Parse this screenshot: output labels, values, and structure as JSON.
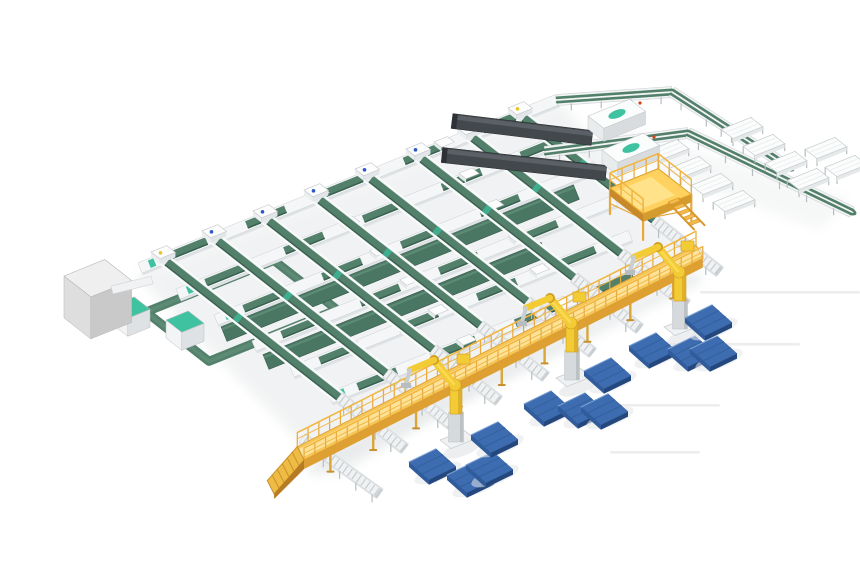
{
  "meta": {
    "title": "Isometric 3D rendering of an automated parcel sorting and palletizing facility",
    "canvas": {
      "w": 860,
      "h": 580
    },
    "background": "#ffffff"
  },
  "colors": {
    "belt": "#53806b",
    "belt_dark": "#39604f",
    "belt_wide": "#4a7763",
    "teal": "#3fc2a0",
    "rail_white": "#f4f6f7",
    "rail_edge": "#c9ced2",
    "roller": "#c3cacd",
    "leg": "#b7bdc0",
    "deck_yellow": "#f6c556",
    "deck_floor": "#fce399",
    "yellow_mid": "#e8a83c",
    "yellow_dark": "#c8892a",
    "platform_top": "#ffd15e",
    "robot_yellow": "#f2cb35",
    "robot_dark": "#cf9d22",
    "robot_light": "#ffe063",
    "pallet_top": "#3e6cb0",
    "pallet_left": "#315c9c",
    "pallet_front": "#24487e",
    "pallet_line": "#32619f",
    "loader_body": "#43484c",
    "loader_top": "#5a6065",
    "loader_tip": "#2e3236",
    "box_top": "#efefef",
    "box_front": "#dedede",
    "box_side": "#c9c9c9",
    "shadow": "#e7e9ea",
    "streak": "#ededed",
    "dot_blue": "#2b59c4",
    "dot_yellow": "#e8c52b",
    "dot_red": "#d84315"
  },
  "scene": {
    "lattice": {
      "lanes": [
        {
          "x": 140,
          "y": 268,
          "len": 450
        },
        {
          "x": 178,
          "y": 294,
          "len": 430
        },
        {
          "x": 216,
          "y": 320,
          "len": 410
        },
        {
          "x": 254,
          "y": 346,
          "len": 390
        },
        {
          "x": 292,
          "y": 372,
          "len": 365
        },
        {
          "x": 330,
          "y": 398,
          "len": 340
        }
      ],
      "wide_belts": [
        {
          "x": 224,
          "y": 334,
          "len": 380
        },
        {
          "x": 266,
          "y": 362,
          "len": 300
        }
      ],
      "belts": [
        {
          "s": [
            163,
            259
          ],
          "t": [
            405,
            449
          ],
          "dot": "#e8c52b"
        },
        {
          "s": [
            214,
            238
          ],
          "t": [
            452,
            425
          ],
          "dot": "#2b59c4"
        },
        {
          "s": [
            265,
            218
          ],
          "t": [
            499,
            401
          ],
          "dot": "#2b59c4"
        },
        {
          "s": [
            316,
            197
          ],
          "t": [
            546,
            377
          ],
          "dot": "#2b59c4"
        },
        {
          "s": [
            367,
            176
          ],
          "t": [
            593,
            353
          ],
          "dot": "#2b59c4"
        },
        {
          "s": [
            418,
            156
          ],
          "t": [
            640,
            329
          ],
          "dot": "#2b59c4"
        },
        {
          "s": [
            469,
            135
          ],
          "t": [
            687,
            305
          ],
          "dot": "#2b59c4"
        },
        {
          "s": [
            520,
            115
          ],
          "t": [
            720,
            272
          ],
          "dot": "#e8c52b"
        }
      ],
      "extra_spurs": [
        {
          "s": [
            302,
            438
          ],
          "t": [
            380,
            494
          ]
        }
      ],
      "spur_len": 84
    },
    "walkway": {
      "p1": [
        300,
        452
      ],
      "p2": [
        688,
        256
      ],
      "ramp_vec": [
        -30,
        34
      ]
    },
    "robots": [
      {
        "x": 456,
        "y": 442
      },
      {
        "x": 572,
        "y": 380
      },
      {
        "x": 680,
        "y": 329
      }
    ],
    "pallets": [
      {
        "x": 432,
        "y": 464
      },
      {
        "x": 470,
        "y": 477
      },
      {
        "x": 489,
        "y": 467
      },
      {
        "x": 494,
        "y": 437
      },
      {
        "x": 547,
        "y": 406
      },
      {
        "x": 581,
        "y": 408
      },
      {
        "x": 604,
        "y": 409
      },
      {
        "x": 607,
        "y": 373
      },
      {
        "x": 652,
        "y": 348
      },
      {
        "x": 691,
        "y": 351
      },
      {
        "x": 713,
        "y": 351
      },
      {
        "x": 708,
        "y": 320
      }
    ],
    "platform": {
      "o": [
        610,
        188
      ],
      "a": 52,
      "b": 42,
      "h": 26
    },
    "loaders": [
      {
        "boom": [
          [
            452,
            121
          ],
          [
            592,
            138
          ]
        ],
        "base": [
          588,
          116
        ],
        "teal": [
          617,
          114
        ],
        "red": [
          640,
          103
        ]
      },
      {
        "boom": [
          [
            442,
            155
          ],
          [
            606,
            173
          ]
        ],
        "base": [
          602,
          150
        ],
        "teal": [
          631,
          148
        ],
        "red": [
          654,
          137
        ]
      }
    ],
    "lines": {
      "top": [
        [
          557,
          100
        ],
        [
          672,
          92
        ]
      ],
      "spineA": [
        [
          672,
          92
        ],
        [
          790,
          168
        ]
      ],
      "spineM": [
        [
          545,
          152
        ],
        [
          688,
          133
        ],
        [
          852,
          212
        ]
      ]
    },
    "chutes": [
      {
        "x": 668,
        "y": 150
      },
      {
        "x": 690,
        "y": 167
      },
      {
        "x": 712,
        "y": 184
      },
      {
        "x": 734,
        "y": 201
      },
      {
        "x": 742,
        "y": 128
      },
      {
        "x": 764,
        "y": 145
      },
      {
        "x": 786,
        "y": 162
      },
      {
        "x": 808,
        "y": 179
      },
      {
        "x": 826,
        "y": 148
      },
      {
        "x": 846,
        "y": 166
      }
    ],
    "gray_box": {
      "o": [
        64,
        276
      ],
      "a": 44,
      "b": 34,
      "h": 42
    },
    "connector": {
      "s": [
        112,
        290
      ],
      "t": [
        152,
        280
      ]
    },
    "loop": {
      "o": [
        146,
        312
      ],
      "a": 138,
      "b": 80
    },
    "loop_machines": [
      {
        "x": 112,
        "y": 306
      },
      {
        "x": 166,
        "y": 320
      }
    ],
    "floor_streaks": [
      {
        "x": 700,
        "y": 291,
        "len": 160
      },
      {
        "x": 650,
        "y": 343,
        "len": 150
      },
      {
        "x": 600,
        "y": 404,
        "len": 120
      },
      {
        "x": 610,
        "y": 451,
        "len": 90
      }
    ]
  }
}
